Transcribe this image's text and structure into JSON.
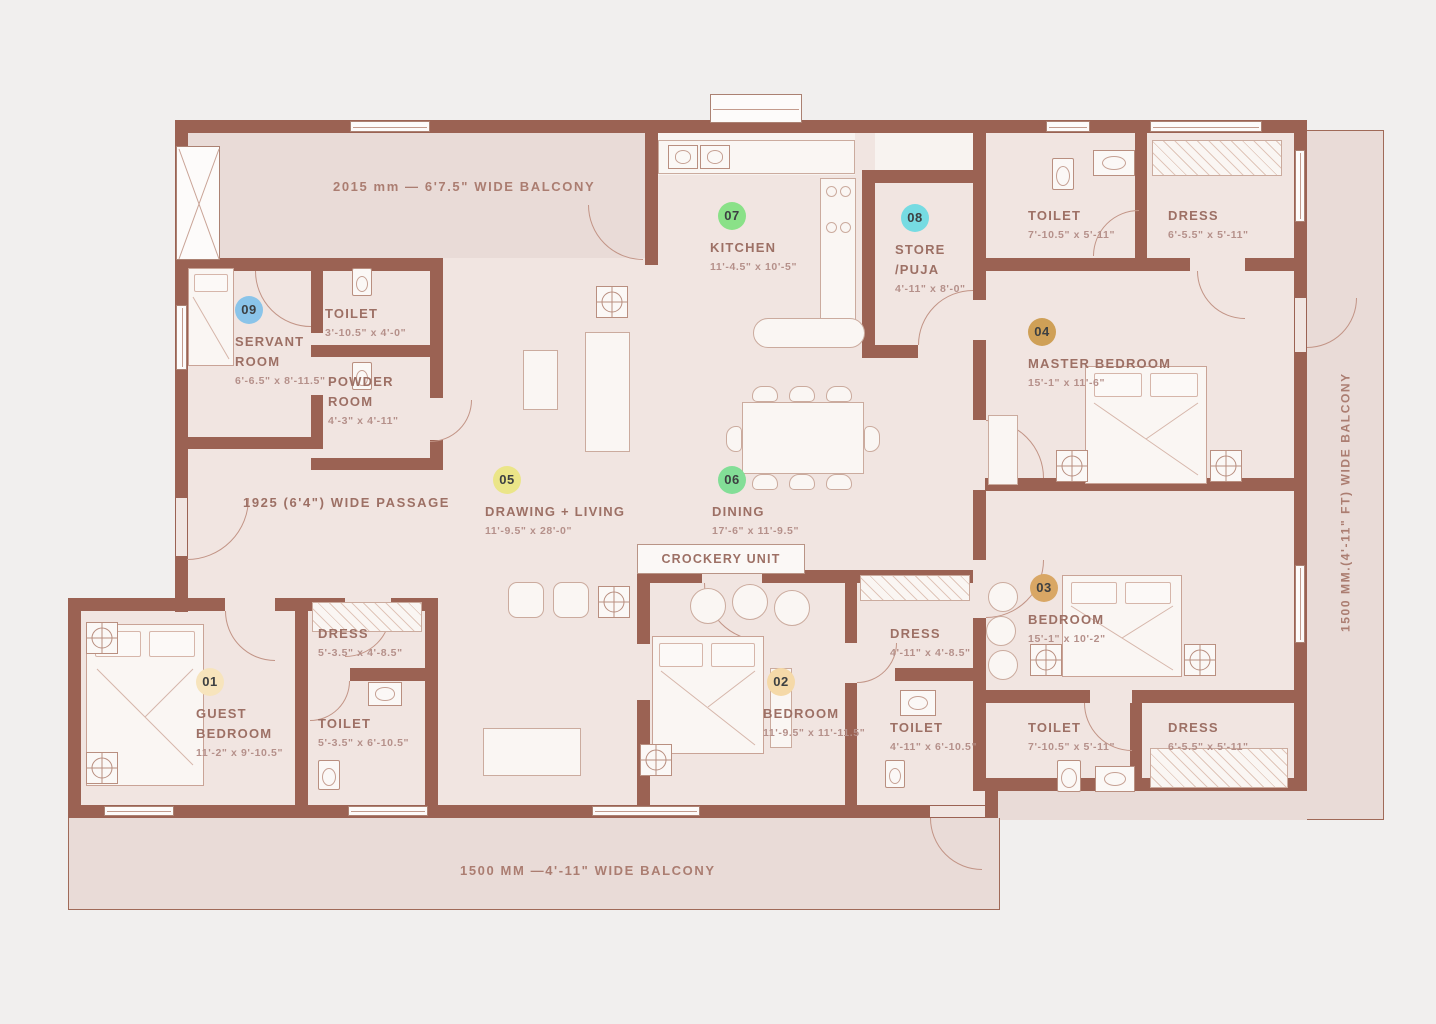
{
  "colors": {
    "wall": "#9b6253",
    "balcony_fill": "#e9dbd7",
    "room_fill": "#f1e5e1",
    "background": "#f1efee"
  },
  "balconies": {
    "top": "2015 mm — 6'7.5\" WIDE BALCONY",
    "right": "1500 MM.(4'-11\" FT) WIDE BALCONY",
    "bottom": "1500 MM —4'-11\"  WIDE BALCONY"
  },
  "passage": "1925 (6'4\") WIDE PASSAGE",
  "crockery": "CROCKERY UNIT",
  "rooms": {
    "guest": {
      "num": "01",
      "name1": "GUEST",
      "name2": "BEDROOM",
      "dims": "11'-2\" x 9'-10.5\"",
      "badge": "#f7e4bc"
    },
    "bed2": {
      "num": "02",
      "name1": "BEDROOM",
      "name2": "",
      "dims": "11'-9.5\" x 11'-11.5\"",
      "badge": "#f5d9a8"
    },
    "bed3": {
      "num": "03",
      "name1": "BEDROOM",
      "name2": "",
      "dims": "15'-1\" x 10'-2\"",
      "badge": "#d9a765"
    },
    "master": {
      "num": "04",
      "name1": "MASTER BEDROOM",
      "name2": "",
      "dims": "15'-1\" x 11'-6\"",
      "badge": "#cfa057"
    },
    "drawing": {
      "num": "05",
      "name1": "DRAWING + LIVING",
      "name2": "",
      "dims": "11'-9.5\" x 28'-0\"",
      "badge": "#ebe588"
    },
    "dining": {
      "num": "06",
      "name1": "DINING",
      "name2": "",
      "dims": "17'-6\" x 11'-9.5\"",
      "badge": "#83de97"
    },
    "kitchen": {
      "num": "07",
      "name1": "KITCHEN",
      "name2": "",
      "dims": "11'-4.5\" x 10'-5\"",
      "badge": "#8ae188"
    },
    "store": {
      "num": "08",
      "name1": "STORE",
      "name2": "/PUJA",
      "dims": "4'-11\" x 8'-0\"",
      "badge": "#76dbe2"
    },
    "servant": {
      "num": "09",
      "name1": "SERVANT",
      "name2": "ROOM",
      "dims": "6'-6.5\" x 8'-11.5\"",
      "badge": "#8ac4e9"
    }
  },
  "subrooms": {
    "toilet_servant": {
      "name": "TOILET",
      "dims": "3'-10.5\" x 4'-0\""
    },
    "powder": {
      "name1": "POWDER",
      "name2": "ROOM",
      "dims": "4'-3\" x 4'-11\""
    },
    "toilet_tr": {
      "name": "TOILET",
      "dims": "7'-10.5\" x 5'-11\""
    },
    "dress_tr": {
      "name": "DRESS",
      "dims": "6'-5.5\" x 5'-11\""
    },
    "dress_guest": {
      "name": "DRESS",
      "dims": "5'-3.5\" x 4'-8.5\""
    },
    "toilet_guest": {
      "name": "TOILET",
      "dims": "5'-3.5\" x 6'-10.5\""
    },
    "dress_bed2": {
      "name": "DRESS",
      "dims": "4'-11\" x 4'-8.5\""
    },
    "toilet_bed2": {
      "name": "TOILET",
      "dims": "4'-11\" x 6'-10.5\""
    },
    "toilet_br": {
      "name": "TOILET",
      "dims": "7'-10.5\" x 5'-11\""
    },
    "dress_br": {
      "name": "DRESS",
      "dims": "6'-5.5\" x 5'-11\""
    }
  }
}
